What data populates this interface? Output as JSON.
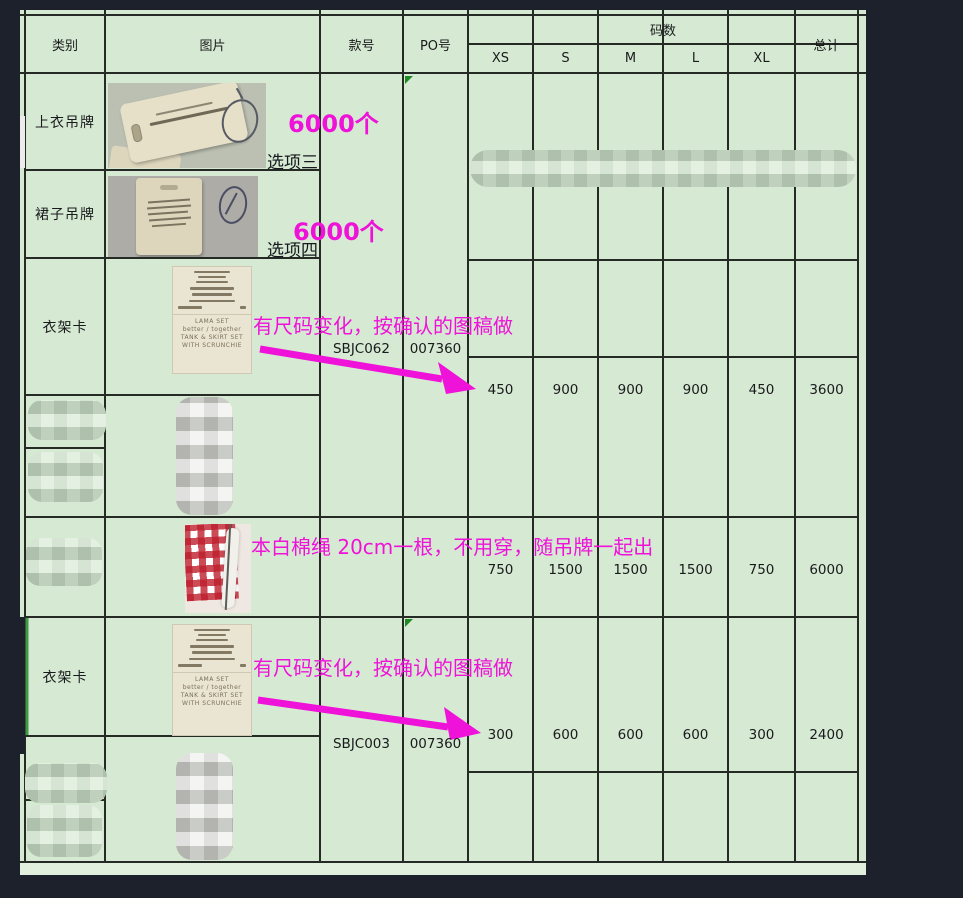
{
  "header": {
    "category": "类别",
    "image": "图片",
    "style_no": "款号",
    "po_no": "PO号",
    "sizes_group": "码数",
    "sizes": [
      "XS",
      "S",
      "M",
      "L",
      "XL"
    ],
    "total": "总计"
  },
  "rows": {
    "top_tag": {
      "label": "上衣吊牌",
      "qty_note": "6000个",
      "option": "选项三"
    },
    "skirt_tag": {
      "label": "裙子吊牌",
      "qty_note": "6000个",
      "option": "选项四"
    },
    "hanger_card_1": {
      "label": "衣架卡",
      "note": "有尺码变化，按确认的图稿做",
      "style_no": "SBJC062",
      "po_no": "007360",
      "sizes": [
        450,
        900,
        900,
        900,
        450
      ],
      "total": 3600
    },
    "cotton_rope": {
      "note": "本白棉绳 20cm一根，不用穿，随吊牌一起出",
      "sizes": [
        750,
        1500,
        1500,
        1500,
        750
      ],
      "total": 6000
    },
    "hanger_card_2": {
      "label": "衣架卡",
      "note": "有尺码变化，按确认的图稿做",
      "style_no": "SBJC003",
      "po_no": "007360",
      "sizes": [
        300,
        600,
        600,
        600,
        300
      ],
      "total": 2400
    }
  },
  "card": {
    "lines": [
      "LAMA SET",
      "better / together",
      "TANK & SKIRT SET",
      "WITH SCRUNCHIE"
    ]
  },
  "colors": {
    "accent_pink": "#ef12d8",
    "table_green": "#d6ead3",
    "bg_dark": "#1c212b",
    "marker_green": "#1f8a22",
    "selection_green": "#3f9a43"
  }
}
